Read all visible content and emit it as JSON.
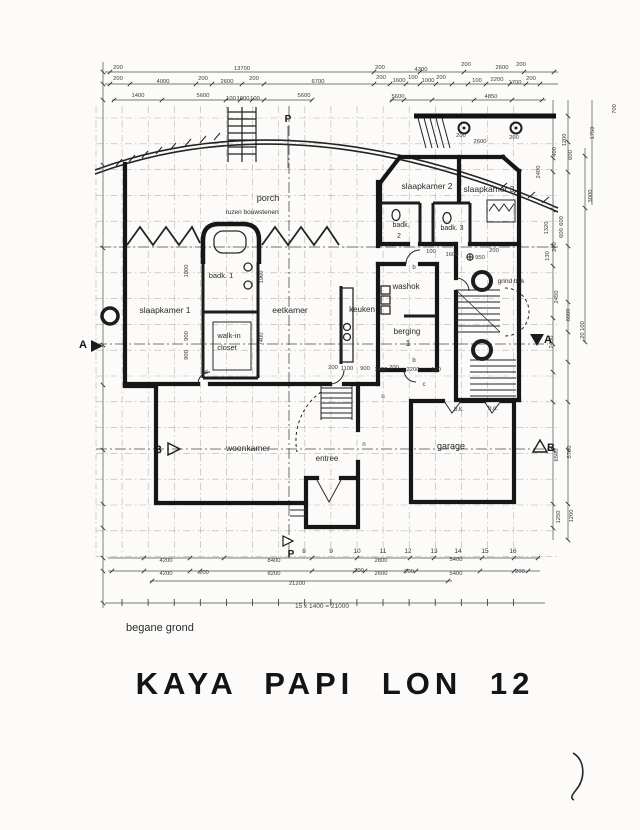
{
  "page": {
    "title": "KAYA PAPI LON 12",
    "floor_label": "begane grond",
    "scale_note": "15 x 1400 = 21000"
  },
  "room_labels": [
    {
      "t": "porch",
      "x": 268,
      "y": 201,
      "s": 9
    },
    {
      "t": "ruzen bouwstenen",
      "x": 252,
      "y": 214,
      "s": 6.5
    },
    {
      "t": "slaapkamer 1",
      "x": 165,
      "y": 313,
      "s": 8.5
    },
    {
      "t": "badk. 1",
      "x": 221,
      "y": 278,
      "s": 7.5
    },
    {
      "t": "walk-in",
      "x": 229,
      "y": 338,
      "s": 7.5
    },
    {
      "t": "closet",
      "x": 227,
      "y": 350,
      "s": 7.5
    },
    {
      "t": "eetkamer",
      "x": 290,
      "y": 313,
      "s": 8.5
    },
    {
      "t": "keuken",
      "x": 362,
      "y": 312,
      "s": 8
    },
    {
      "t": "washok",
      "x": 406,
      "y": 289,
      "s": 8
    },
    {
      "t": "berging",
      "x": 407,
      "y": 334,
      "s": 8
    },
    {
      "t": "1",
      "x": 408,
      "y": 346,
      "s": 8
    },
    {
      "t": "slaapkamer 2",
      "x": 427,
      "y": 189,
      "s": 8.5
    },
    {
      "t": "slaapkamer 3",
      "x": 489,
      "y": 192,
      "s": 8.5
    },
    {
      "t": "badk.",
      "x": 401,
      "y": 227,
      "s": 7
    },
    {
      "t": "2",
      "x": 399,
      "y": 238,
      "s": 7
    },
    {
      "t": "badk. 3",
      "x": 452,
      "y": 230,
      "s": 7
    },
    {
      "t": "woonkamer",
      "x": 248,
      "y": 451,
      "s": 8.5
    },
    {
      "t": "entree",
      "x": 327,
      "y": 461,
      "s": 8
    },
    {
      "t": "garage",
      "x": 451,
      "y": 449,
      "s": 9
    },
    {
      "t": "grind bak",
      "x": 511,
      "y": 283,
      "s": 6.5
    },
    {
      "t": "b.k.",
      "x": 459,
      "y": 411,
      "s": 6
    },
    {
      "t": "b.c.",
      "x": 493,
      "y": 410,
      "s": 6
    }
  ],
  "door_tags": [
    {
      "t": "d",
      "x": 206,
      "y": 374
    },
    {
      "t": "b",
      "x": 414,
      "y": 269
    },
    {
      "t": "b",
      "x": 414,
      "y": 362
    },
    {
      "t": "c",
      "x": 424,
      "y": 386
    },
    {
      "t": "n",
      "x": 383,
      "y": 398
    },
    {
      "t": "n",
      "x": 364,
      "y": 446
    }
  ],
  "section_letters": [
    {
      "t": "A",
      "x": 83,
      "y": 348,
      "s": 11
    },
    {
      "t": "A",
      "x": 548,
      "y": 343,
      "s": 11
    },
    {
      "t": "B",
      "x": 158,
      "y": 453,
      "s": 11
    },
    {
      "t": "B",
      "x": 551,
      "y": 451,
      "s": 11
    },
    {
      "t": "P",
      "x": 288,
      "y": 122,
      "s": 10
    },
    {
      "t": "P",
      "x": 291,
      "y": 557,
      "s": 10
    }
  ],
  "grid_numbers": [
    {
      "t": "8",
      "x": 304,
      "y": 553
    },
    {
      "t": "9",
      "x": 331,
      "y": 553
    },
    {
      "t": "10",
      "x": 357,
      "y": 553
    },
    {
      "t": "11",
      "x": 383,
      "y": 553
    },
    {
      "t": "12",
      "x": 408,
      "y": 553
    },
    {
      "t": "13",
      "x": 434,
      "y": 553
    },
    {
      "t": "14",
      "x": 458,
      "y": 553
    },
    {
      "t": "15",
      "x": 485,
      "y": 553
    },
    {
      "t": "16",
      "x": 513,
      "y": 553
    }
  ],
  "dim_labels": [
    {
      "t": "200",
      "x": 118,
      "y": 69
    },
    {
      "t": "13700",
      "x": 242,
      "y": 70
    },
    {
      "t": "200",
      "x": 380,
      "y": 69
    },
    {
      "t": "4300",
      "x": 421,
      "y": 71
    },
    {
      "t": "200",
      "x": 466,
      "y": 66
    },
    {
      "t": "2600",
      "x": 502,
      "y": 69
    },
    {
      "t": "200",
      "x": 521,
      "y": 66
    },
    {
      "t": "200",
      "x": 118,
      "y": 80
    },
    {
      "t": "4000",
      "x": 163,
      "y": 83
    },
    {
      "t": "200",
      "x": 203,
      "y": 80
    },
    {
      "t": "2600",
      "x": 227,
      "y": 83
    },
    {
      "t": "200",
      "x": 254,
      "y": 80
    },
    {
      "t": "6700",
      "x": 318,
      "y": 83
    },
    {
      "t": "200",
      "x": 381,
      "y": 79
    },
    {
      "t": "1600",
      "x": 399,
      "y": 82
    },
    {
      "t": "100",
      "x": 413,
      "y": 79
    },
    {
      "t": "1000",
      "x": 428,
      "y": 82
    },
    {
      "t": "200",
      "x": 441,
      "y": 79
    },
    {
      "t": "100",
      "x": 477,
      "y": 82
    },
    {
      "t": "2200",
      "x": 497,
      "y": 81
    },
    {
      "t": "1700",
      "x": 515,
      "y": 84
    },
    {
      "t": "200",
      "x": 531,
      "y": 80
    },
    {
      "t": "1400",
      "x": 138,
      "y": 97
    },
    {
      "t": "5600",
      "x": 203,
      "y": 97
    },
    {
      "t": "100",
      "x": 231,
      "y": 100
    },
    {
      "t": "1000",
      "x": 243,
      "y": 100
    },
    {
      "t": "100",
      "x": 255,
      "y": 100
    },
    {
      "t": "5600",
      "x": 304,
      "y": 97
    },
    {
      "t": "5600",
      "x": 398,
      "y": 98
    },
    {
      "t": "4850",
      "x": 491,
      "y": 98
    },
    {
      "t": "200",
      "x": 461,
      "y": 137
    },
    {
      "t": "2600",
      "x": 480,
      "y": 143
    },
    {
      "t": "200",
      "x": 514,
      "y": 139
    },
    {
      "t": "100",
      "x": 431,
      "y": 253
    },
    {
      "t": "1600",
      "x": 452,
      "y": 256
    },
    {
      "t": "950",
      "x": 480,
      "y": 259
    },
    {
      "t": "200",
      "x": 494,
      "y": 252
    },
    {
      "t": "200",
      "x": 333,
      "y": 369
    },
    {
      "t": "1100",
      "x": 347,
      "y": 370
    },
    {
      "t": "900",
      "x": 365,
      "y": 370
    },
    {
      "t": "1450",
      "x": 381,
      "y": 371
    },
    {
      "t": "200",
      "x": 394,
      "y": 369
    },
    {
      "t": "2200",
      "x": 413,
      "y": 371
    },
    {
      "t": "100",
      "x": 436,
      "y": 371
    },
    {
      "t": "1000",
      "x": 188,
      "y": 271,
      "r": -90
    },
    {
      "t": "900",
      "x": 188,
      "y": 336,
      "r": -90
    },
    {
      "t": "900",
      "x": 188,
      "y": 355,
      "r": -90
    },
    {
      "t": "1960",
      "x": 263,
      "y": 277,
      "r": -90
    },
    {
      "t": "7400",
      "x": 263,
      "y": 339,
      "r": -90
    },
    {
      "t": "700",
      "x": 616,
      "y": 109,
      "r": -90
    },
    {
      "t": "1750",
      "x": 594,
      "y": 133,
      "r": -90
    },
    {
      "t": "1200",
      "x": 566,
      "y": 140,
      "r": -90
    },
    {
      "t": "400",
      "x": 556,
      "y": 152,
      "r": -90
    },
    {
      "t": "600",
      "x": 572,
      "y": 155,
      "r": -90
    },
    {
      "t": "2400",
      "x": 540,
      "y": 172,
      "r": -90
    },
    {
      "t": "3000",
      "x": 592,
      "y": 196,
      "r": -90
    },
    {
      "t": "600",
      "x": 563,
      "y": 221,
      "r": -90
    },
    {
      "t": "600",
      "x": 563,
      "y": 233,
      "r": -90
    },
    {
      "t": "1320",
      "x": 548,
      "y": 228,
      "r": -90
    },
    {
      "t": "200",
      "x": 556,
      "y": 247,
      "r": -90
    },
    {
      "t": "130",
      "x": 549,
      "y": 256,
      "r": -90
    },
    {
      "t": "2450",
      "x": 558,
      "y": 297,
      "r": -90
    },
    {
      "t": "8000",
      "x": 570,
      "y": 315,
      "r": -90
    },
    {
      "t": "20 100",
      "x": 584,
      "y": 330,
      "r": -90
    },
    {
      "t": "2450",
      "x": 553,
      "y": 342,
      "r": -90
    },
    {
      "t": "6500",
      "x": 558,
      "y": 455,
      "r": -90
    },
    {
      "t": "5700",
      "x": 571,
      "y": 452,
      "r": -90
    },
    {
      "t": "1250",
      "x": 560,
      "y": 517,
      "r": -90
    },
    {
      "t": "1200",
      "x": 573,
      "y": 516,
      "r": -90
    },
    {
      "t": "4200",
      "x": 166,
      "y": 562
    },
    {
      "t": "4200",
      "x": 166,
      "y": 575
    },
    {
      "t": "200",
      "x": 204,
      "y": 574
    },
    {
      "t": "8400",
      "x": 274,
      "y": 562
    },
    {
      "t": "8200",
      "x": 274,
      "y": 575
    },
    {
      "t": "21200",
      "x": 297,
      "y": 585
    },
    {
      "t": "200",
      "x": 359,
      "y": 572
    },
    {
      "t": "2800",
      "x": 381,
      "y": 562
    },
    {
      "t": "2600",
      "x": 381,
      "y": 575
    },
    {
      "t": "200",
      "x": 409,
      "y": 573
    },
    {
      "t": "5400",
      "x": 456,
      "y": 561
    },
    {
      "t": "5400",
      "x": 456,
      "y": 575
    },
    {
      "t": "200",
      "x": 520,
      "y": 573
    }
  ],
  "colors": {
    "ink": "#1a1a1a",
    "dim": "#3a3a3a",
    "grid": "#b5b3ae"
  }
}
